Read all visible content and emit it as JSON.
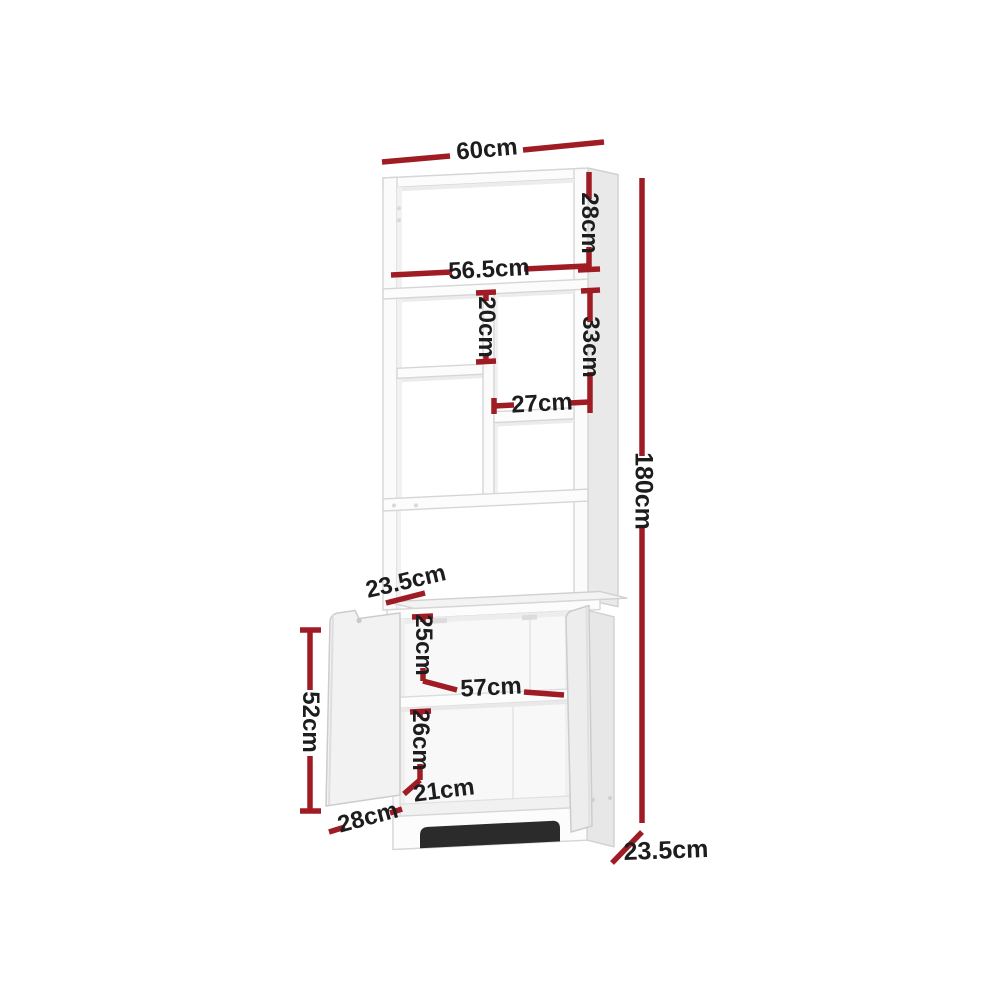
{
  "page": {
    "background_color": "#ffffff"
  },
  "diagram": {
    "subject": "display-shelf-with-cabinet-dimension-diagram",
    "accent_color": "#a01c24",
    "text_color": "#1d1d1d",
    "furniture_fill": "#fcfcfc",
    "furniture_outline": "#d6d6d6",
    "kickboard_shadow_color": "#2b2b2b"
  },
  "dims": {
    "top_width": {
      "label": "60cm"
    },
    "top_opening_height": {
      "label": "28cm"
    },
    "inner_width": {
      "label": "56.5cm"
    },
    "left_cubby_height": {
      "label": "20cm"
    },
    "right_opening_height": {
      "label": "33cm"
    },
    "right_cubby_width": {
      "label": "27cm"
    },
    "total_height": {
      "label": "180cm"
    },
    "upper_depth": {
      "label": "23.5cm"
    },
    "cabinet_top_inner_height": {
      "label": "25cm"
    },
    "cabinet_inner_width": {
      "label": "57cm"
    },
    "cabinet_bottom_inner_height": {
      "label": "26cm"
    },
    "cabinet_inner_depth": {
      "label": "21cm"
    },
    "door_width": {
      "label": "28cm"
    },
    "door_height": {
      "label": "52cm"
    },
    "cabinet_depth": {
      "label": "23.5cm"
    }
  }
}
